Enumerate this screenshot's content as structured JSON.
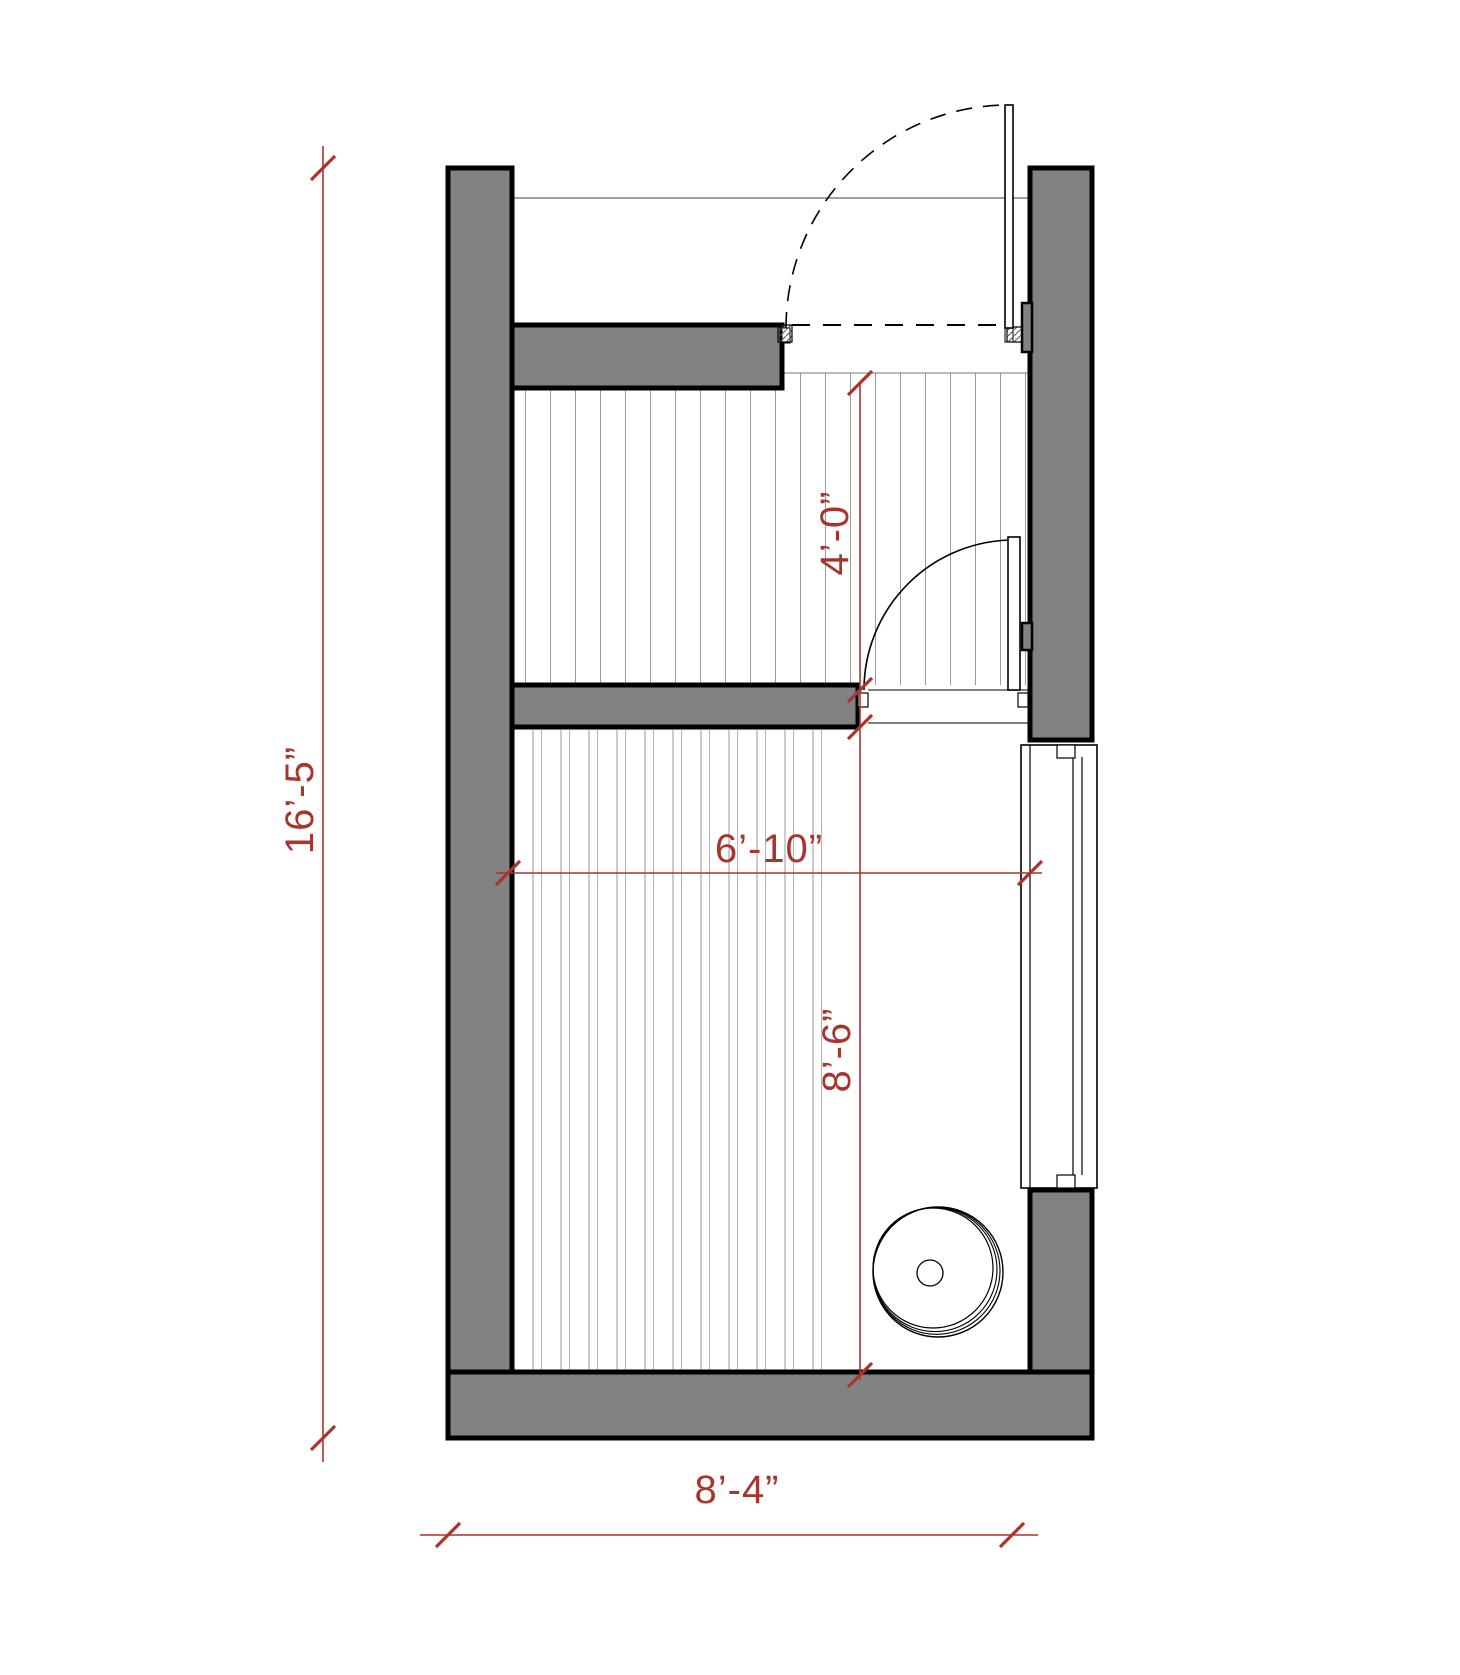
{
  "drawing": {
    "type": "architectural floor plan",
    "dimension_labels": {
      "overall_height": "16’-5”",
      "upper_room_depth": "4’-0”",
      "interior_width": "6’-10”",
      "lower_room_depth": "8’-6”",
      "overall_width": "8’-4”"
    },
    "colors": {
      "wall_fill": "#828282",
      "outline": "#000000",
      "dimension_red": "#a8342e",
      "hatch_gray": "#9a9a9a"
    },
    "symbols": [
      "entry-swing-door-dashed-arc",
      "interior-swing-door",
      "glazed-panel",
      "round-heater"
    ]
  }
}
